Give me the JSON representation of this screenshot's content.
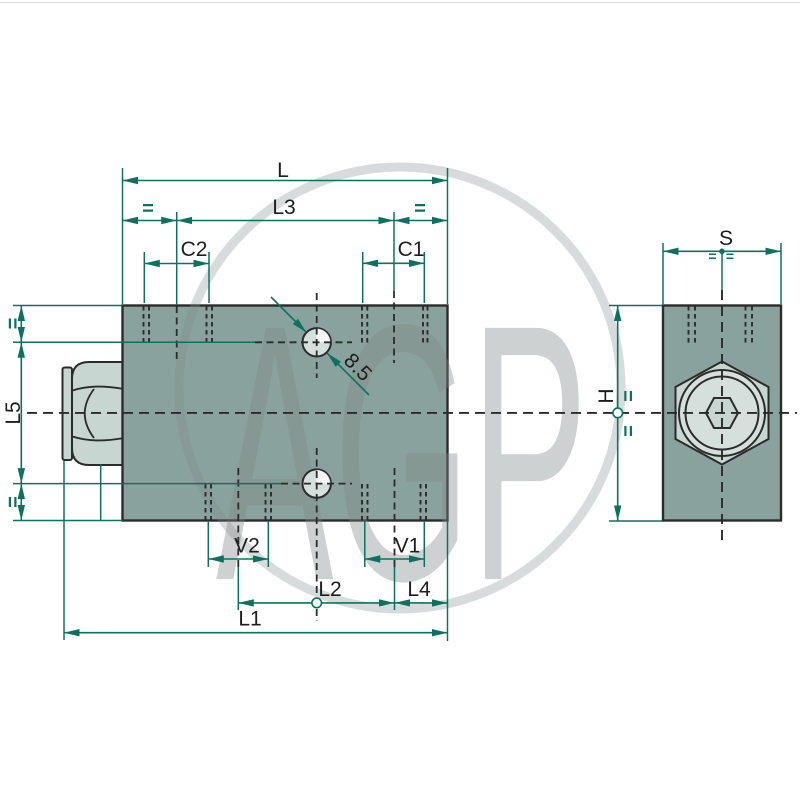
{
  "page": {
    "background": "#ffffff",
    "top_rule": "#d8dcdc"
  },
  "watermark": {
    "text": "AGP"
  },
  "colors": {
    "background": "#ffffff",
    "top_rule": "#d8dcdc",
    "dimension": "#0e7160",
    "outline": "#2b2b2b",
    "block": "#8aa29d",
    "plug": "#c8d6d2",
    "hole": "#d5e0dc",
    "label": "#1d1d1d",
    "watermark": "#7e8888"
  },
  "front_view": {
    "labels": {
      "L": "L",
      "L3": "L3",
      "C2": "C2",
      "C1": "C1",
      "V2": "V2",
      "V1": "V1",
      "L2": "L2",
      "L4": "L4",
      "L1": "L1",
      "L5": "L5",
      "hole_diameter": "8.5",
      "equal_top_left": "=",
      "equal_top_right": "=",
      "equal_left_upper": "=",
      "equal_left_lower": "="
    }
  },
  "side_view": {
    "labels": {
      "S": "S",
      "H": "H",
      "equal_s_left": "=",
      "equal_s_right": "=",
      "equal_h_upper": "=",
      "equal_h_lower": "="
    }
  }
}
